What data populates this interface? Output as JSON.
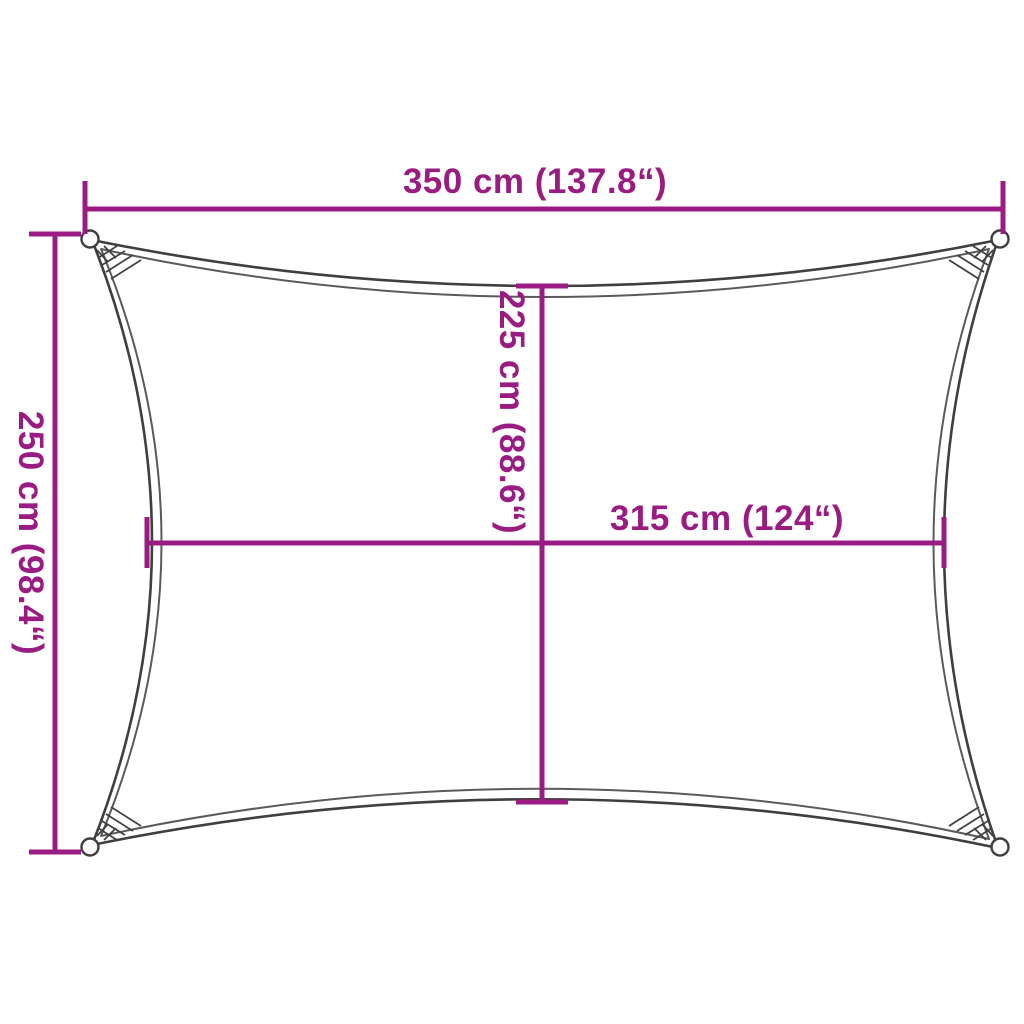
{
  "colors": {
    "dimension": "#9a1b82",
    "sail": "#3f3f3f",
    "sail_light": "#5a5a5a"
  },
  "dimensions": {
    "top_width": {
      "label": "350 cm (137.8“)"
    },
    "left_height": {
      "label": "250 cm (98.4“)"
    },
    "center_height": {
      "label": "225 cm (88.6“)"
    },
    "center_width": {
      "label": "315 cm (124“)"
    }
  }
}
